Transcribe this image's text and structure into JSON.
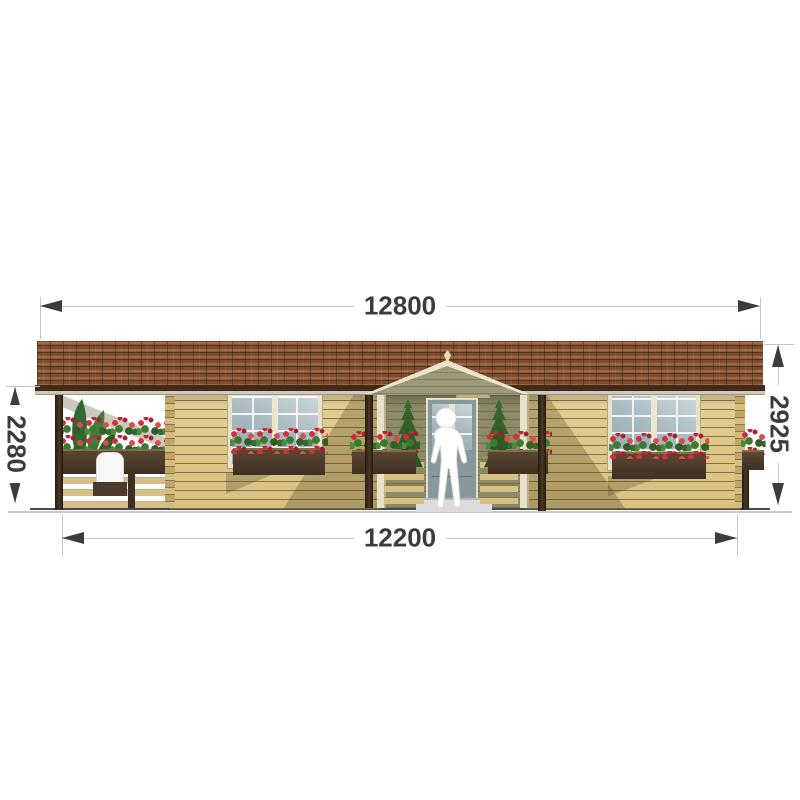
{
  "drawing": {
    "kind": "house front elevation",
    "dimensions": {
      "overall_width": "12800",
      "base_width": "12200",
      "eave_height": "2280",
      "ridge_height": "2925"
    },
    "colors": {
      "roof_shingle_brown": "#7e4e2f",
      "roof_fascia_dark": "#3f2a1b",
      "wall_log_tan": "#dcc78b",
      "gable_olive": "#9c9a78",
      "trim_cream": "#e9e2c9",
      "planter_brown": "#4c3b2c",
      "flower_red": "#d42f38",
      "foliage_green": "#3c7a33",
      "dimension_text": "#3c3c3c",
      "dimension_line": "#c6c6c6",
      "ground_line": "#4a4a4a"
    }
  }
}
